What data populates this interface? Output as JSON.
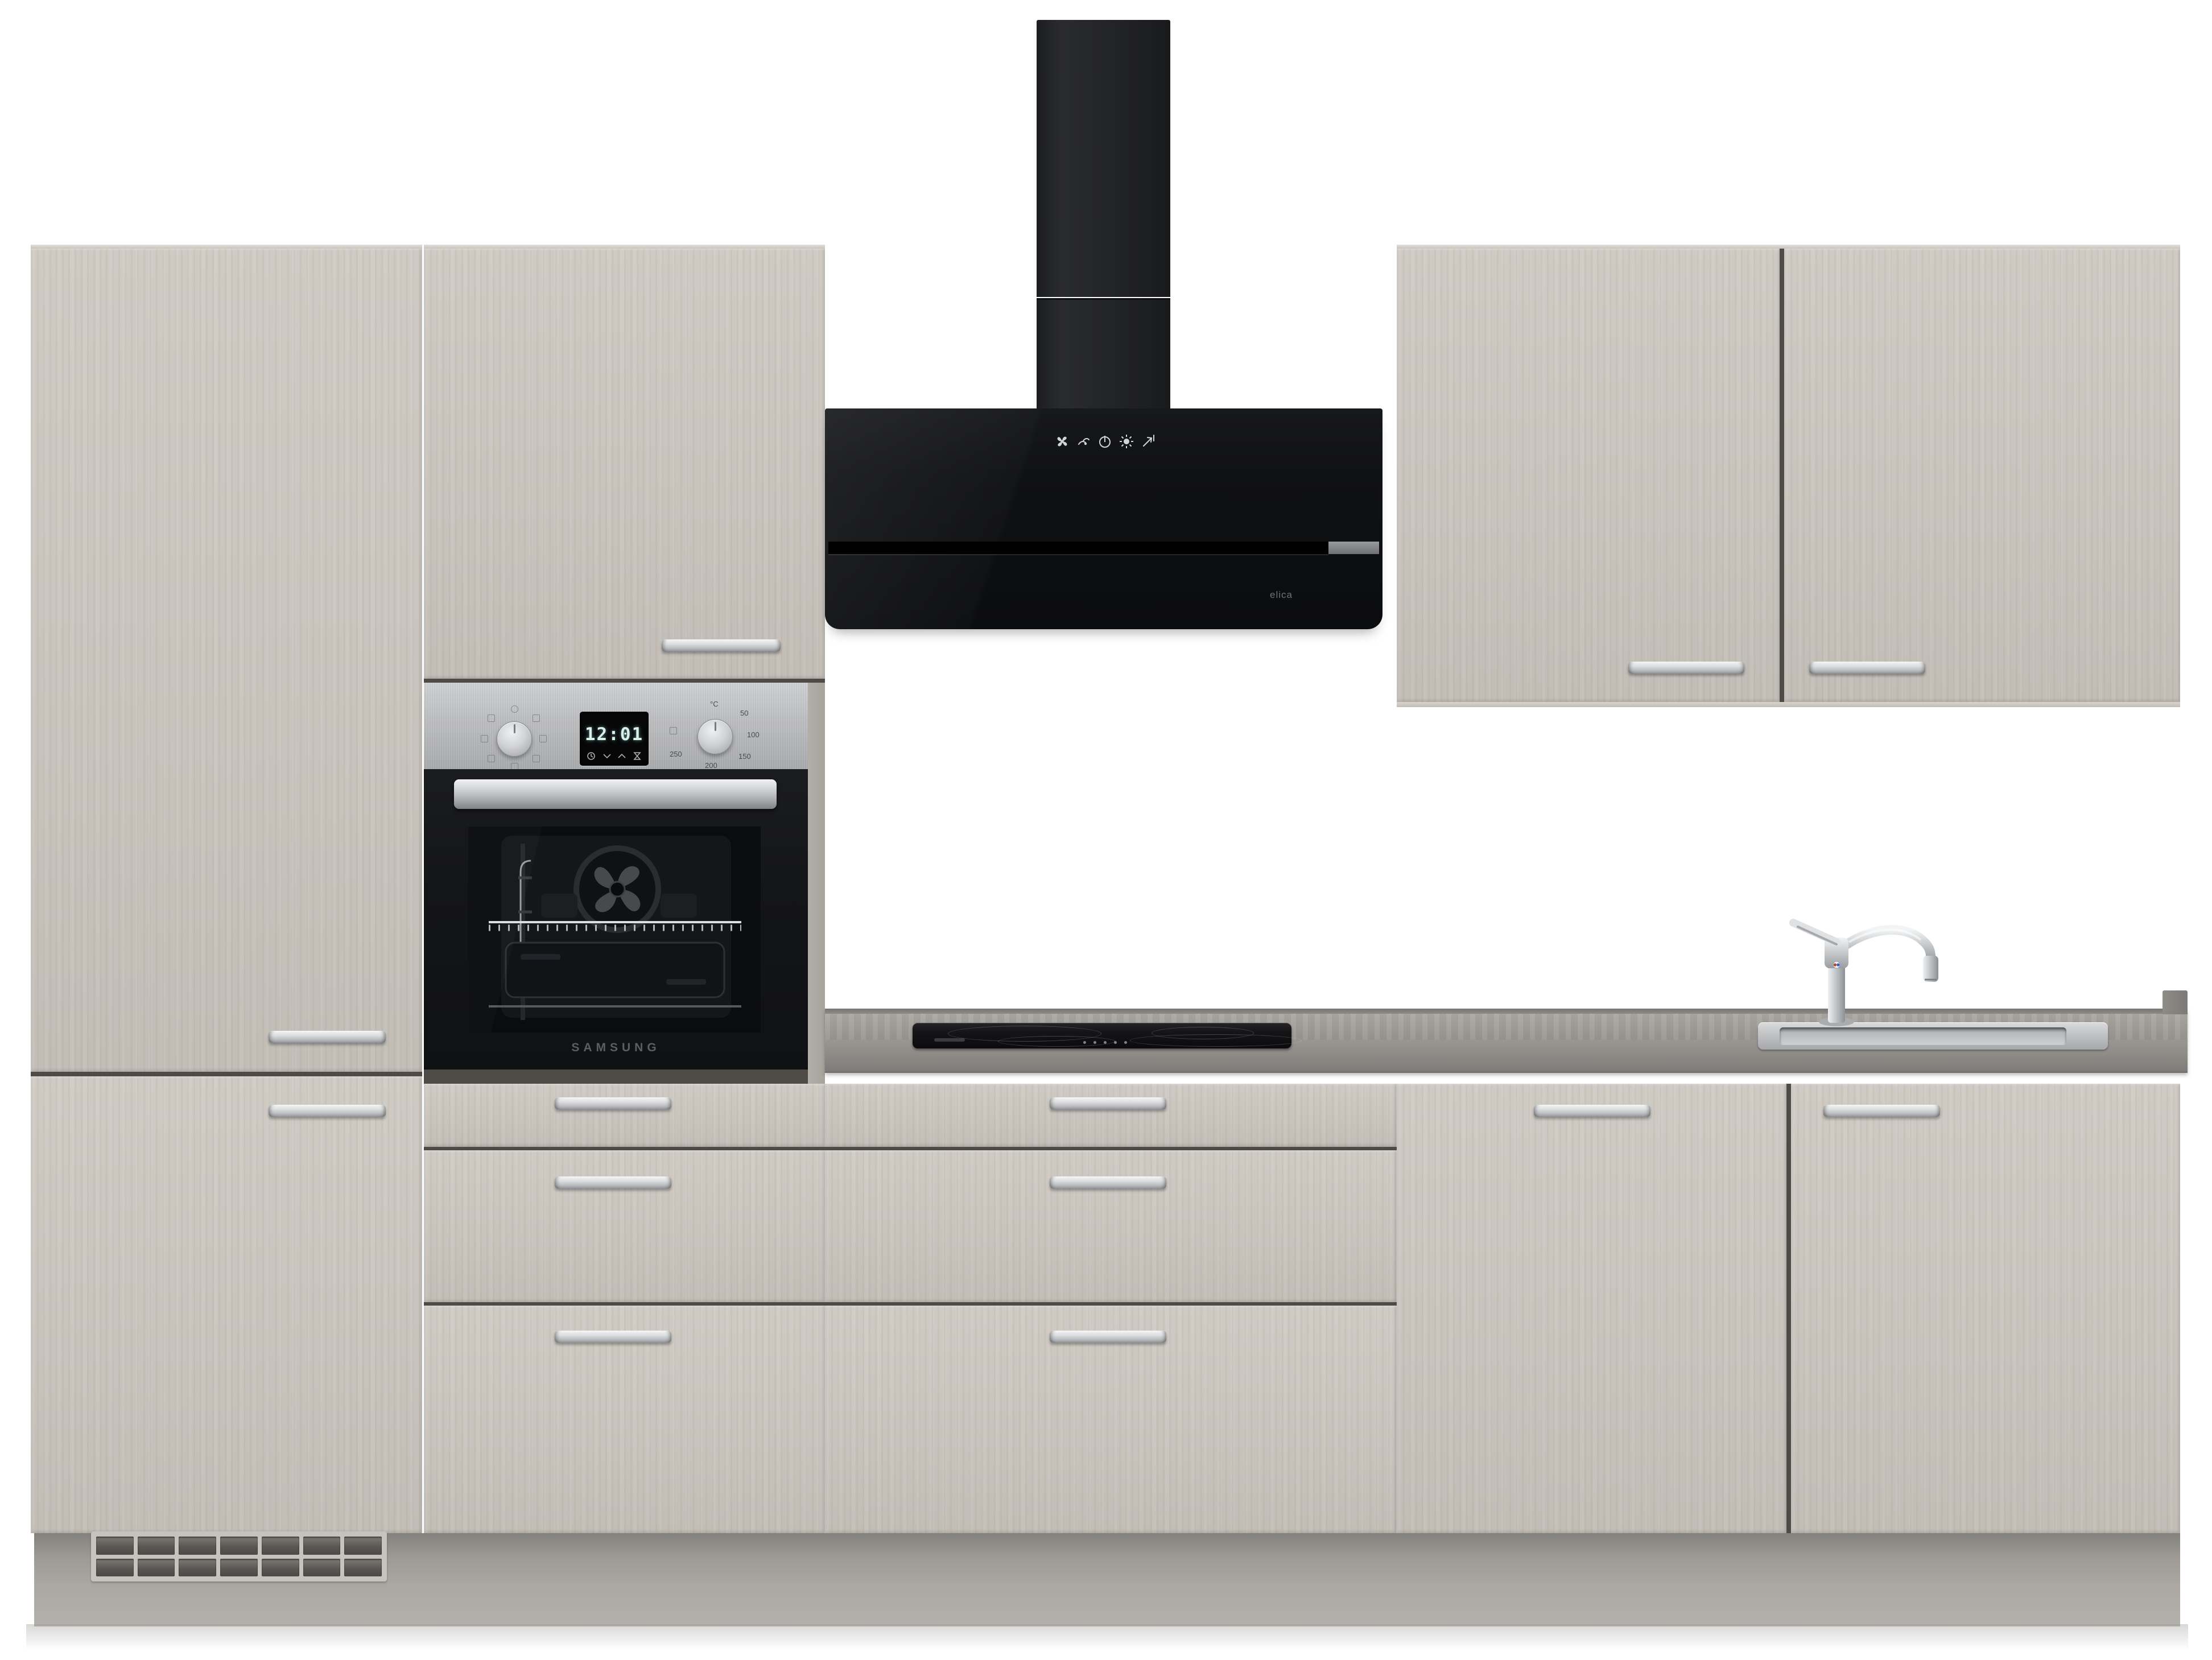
{
  "scene": {
    "description": "Kitchen block product render: concrete-look light grey fronts, black head-free extractor hood, built-in stainless oven, black glass hob, stainless inset sink",
    "colors": {
      "front": "#cbc6bf",
      "counter": "#9b9893",
      "hood_black": "#0d0d0f",
      "stainless": "#c6c8ca",
      "plinth": "#a5a29d",
      "wall": "#ffffff",
      "oven_display_digits": "#d9efe9"
    }
  },
  "oven": {
    "brand": "SAMSUNG",
    "display_time": "12:01",
    "display_buttons": [
      "clock-icon",
      "chevron-down-icon",
      "chevron-up-icon",
      "hourglass-icon"
    ],
    "temp_unit": "°C",
    "temp_ticks": [
      "50",
      "100",
      "150",
      "200",
      "250"
    ]
  },
  "hood": {
    "brand": "elica",
    "touch_controls": [
      "fan-icon",
      "speed-icon",
      "power-icon",
      "light-icon",
      "filter-arrow-icon"
    ]
  },
  "cooktop": {
    "type": "black glass ceramic hob"
  },
  "sink": {
    "type": "stainless inset sink",
    "faucet": "chrome single-lever mixer"
  },
  "cabinets": {
    "handle_style": "stainless bar handle",
    "sections": [
      "left-tall-cabinet",
      "oven-tower",
      "center-drawer-base",
      "right-wall-cabinets",
      "right-base-cabinets"
    ],
    "vent_grille": "plinth ventilation grille"
  }
}
